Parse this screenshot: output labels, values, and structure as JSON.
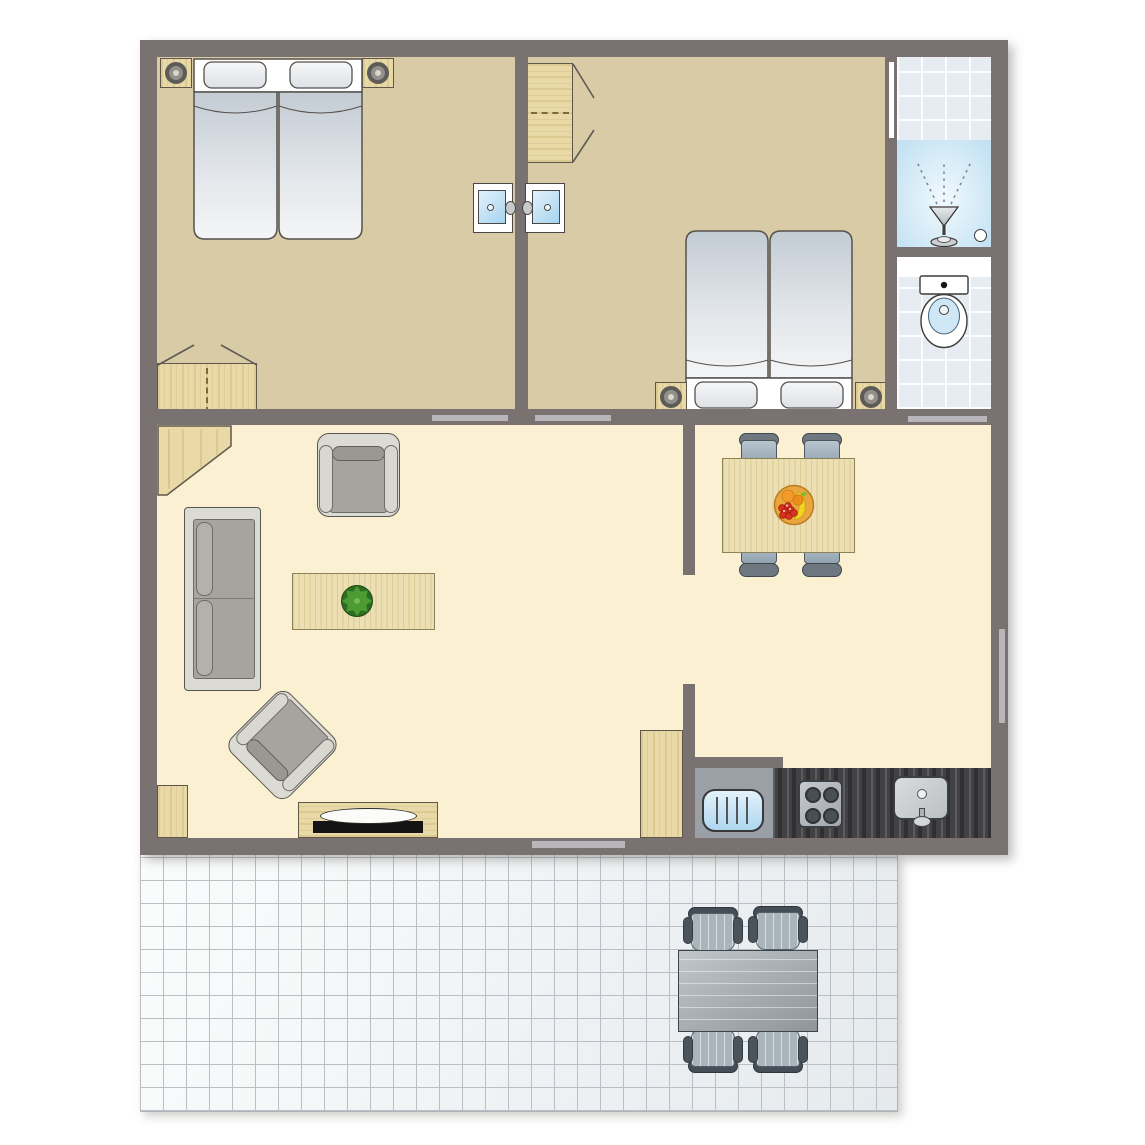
{
  "title": "Two-bedroom holiday apartment floor plan with terrace",
  "labels": {
    "plan": "apartment floor plan",
    "terrace": "tiled terrace",
    "bedroom1": "bedroom 1",
    "bedroom2": "bedroom 2",
    "shower_room": "shower room",
    "wc": "toilet room",
    "living_room": "living room",
    "dining_area": "dining area",
    "kitchen": "kitchenette",
    "bed_double_twin": "double bed (two mattresses)",
    "nightstand": "nightstand with lamp",
    "wardrobe": "wardrobe with folding doors",
    "washbasin": "washbasin",
    "shower": "shower",
    "shower_drain": "shower drain",
    "toilet": "toilet",
    "sofa": "two-seat sofa",
    "armchair": "armchair",
    "armchair_angled": "armchair (angled)",
    "coffee_table": "coffee table",
    "plant": "potted plant",
    "corner_cabinet": "corner cabinet",
    "side_cabinet": "side cabinet",
    "tv_cabinet": "TV cabinet",
    "tv": "television",
    "dining_table": "dining table",
    "dining_chair": "dining chair",
    "fruit_bowl": "fruit bowl",
    "tall_cabinet": "tall kitchen cabinet",
    "dishwasher": "dishwasher",
    "stove": "four-burner stove",
    "kitchen_sink": "kitchen sink",
    "kitchen_counter": "kitchen counter",
    "patio_table": "patio table",
    "patio_chair": "patio chair",
    "door": "door opening",
    "sliding_door": "sliding door to terrace",
    "window": "window"
  },
  "rooms": [
    {
      "name": "bedroom-1",
      "furniture": [
        "double bed",
        "2 nightstands with lamps",
        "wardrobe",
        "washbasin"
      ]
    },
    {
      "name": "bedroom-2",
      "furniture": [
        "double bed",
        "2 nightstands with lamps",
        "wardrobe",
        "washbasin"
      ]
    },
    {
      "name": "shower-room",
      "furniture": [
        "shower",
        "drain"
      ]
    },
    {
      "name": "wc",
      "furniture": [
        "toilet"
      ]
    },
    {
      "name": "living-room",
      "furniture": [
        "sofa",
        "2 armchairs",
        "coffee table with plant",
        "corner cabinet",
        "side cabinet",
        "TV cabinet with TV"
      ]
    },
    {
      "name": "dining-area",
      "furniture": [
        "dining table",
        "4 chairs",
        "fruit bowl"
      ]
    },
    {
      "name": "kitchen",
      "furniture": [
        "counter",
        "stove",
        "sink",
        "dishwasher",
        "tall cabinet"
      ]
    },
    {
      "name": "terrace",
      "furniture": [
        "patio table",
        "4 patio chairs"
      ]
    }
  ],
  "palette": {
    "wall": "#7a7270",
    "bedroom_floor": "#d8cba5",
    "living_floor": "#fbf0d1",
    "bath_tile": "#e7ecf3",
    "terrace_tile": "#f2f4f5",
    "wood": "#e9d9a7",
    "light_wood": "#ecdfb4",
    "upholstery_gray": "#a7a49f",
    "chair_blue_gray": "#a3b3bf",
    "counter_dark": "#424245",
    "water_blue": "#bedff2",
    "threshold_gray": "#b8b6ba"
  }
}
